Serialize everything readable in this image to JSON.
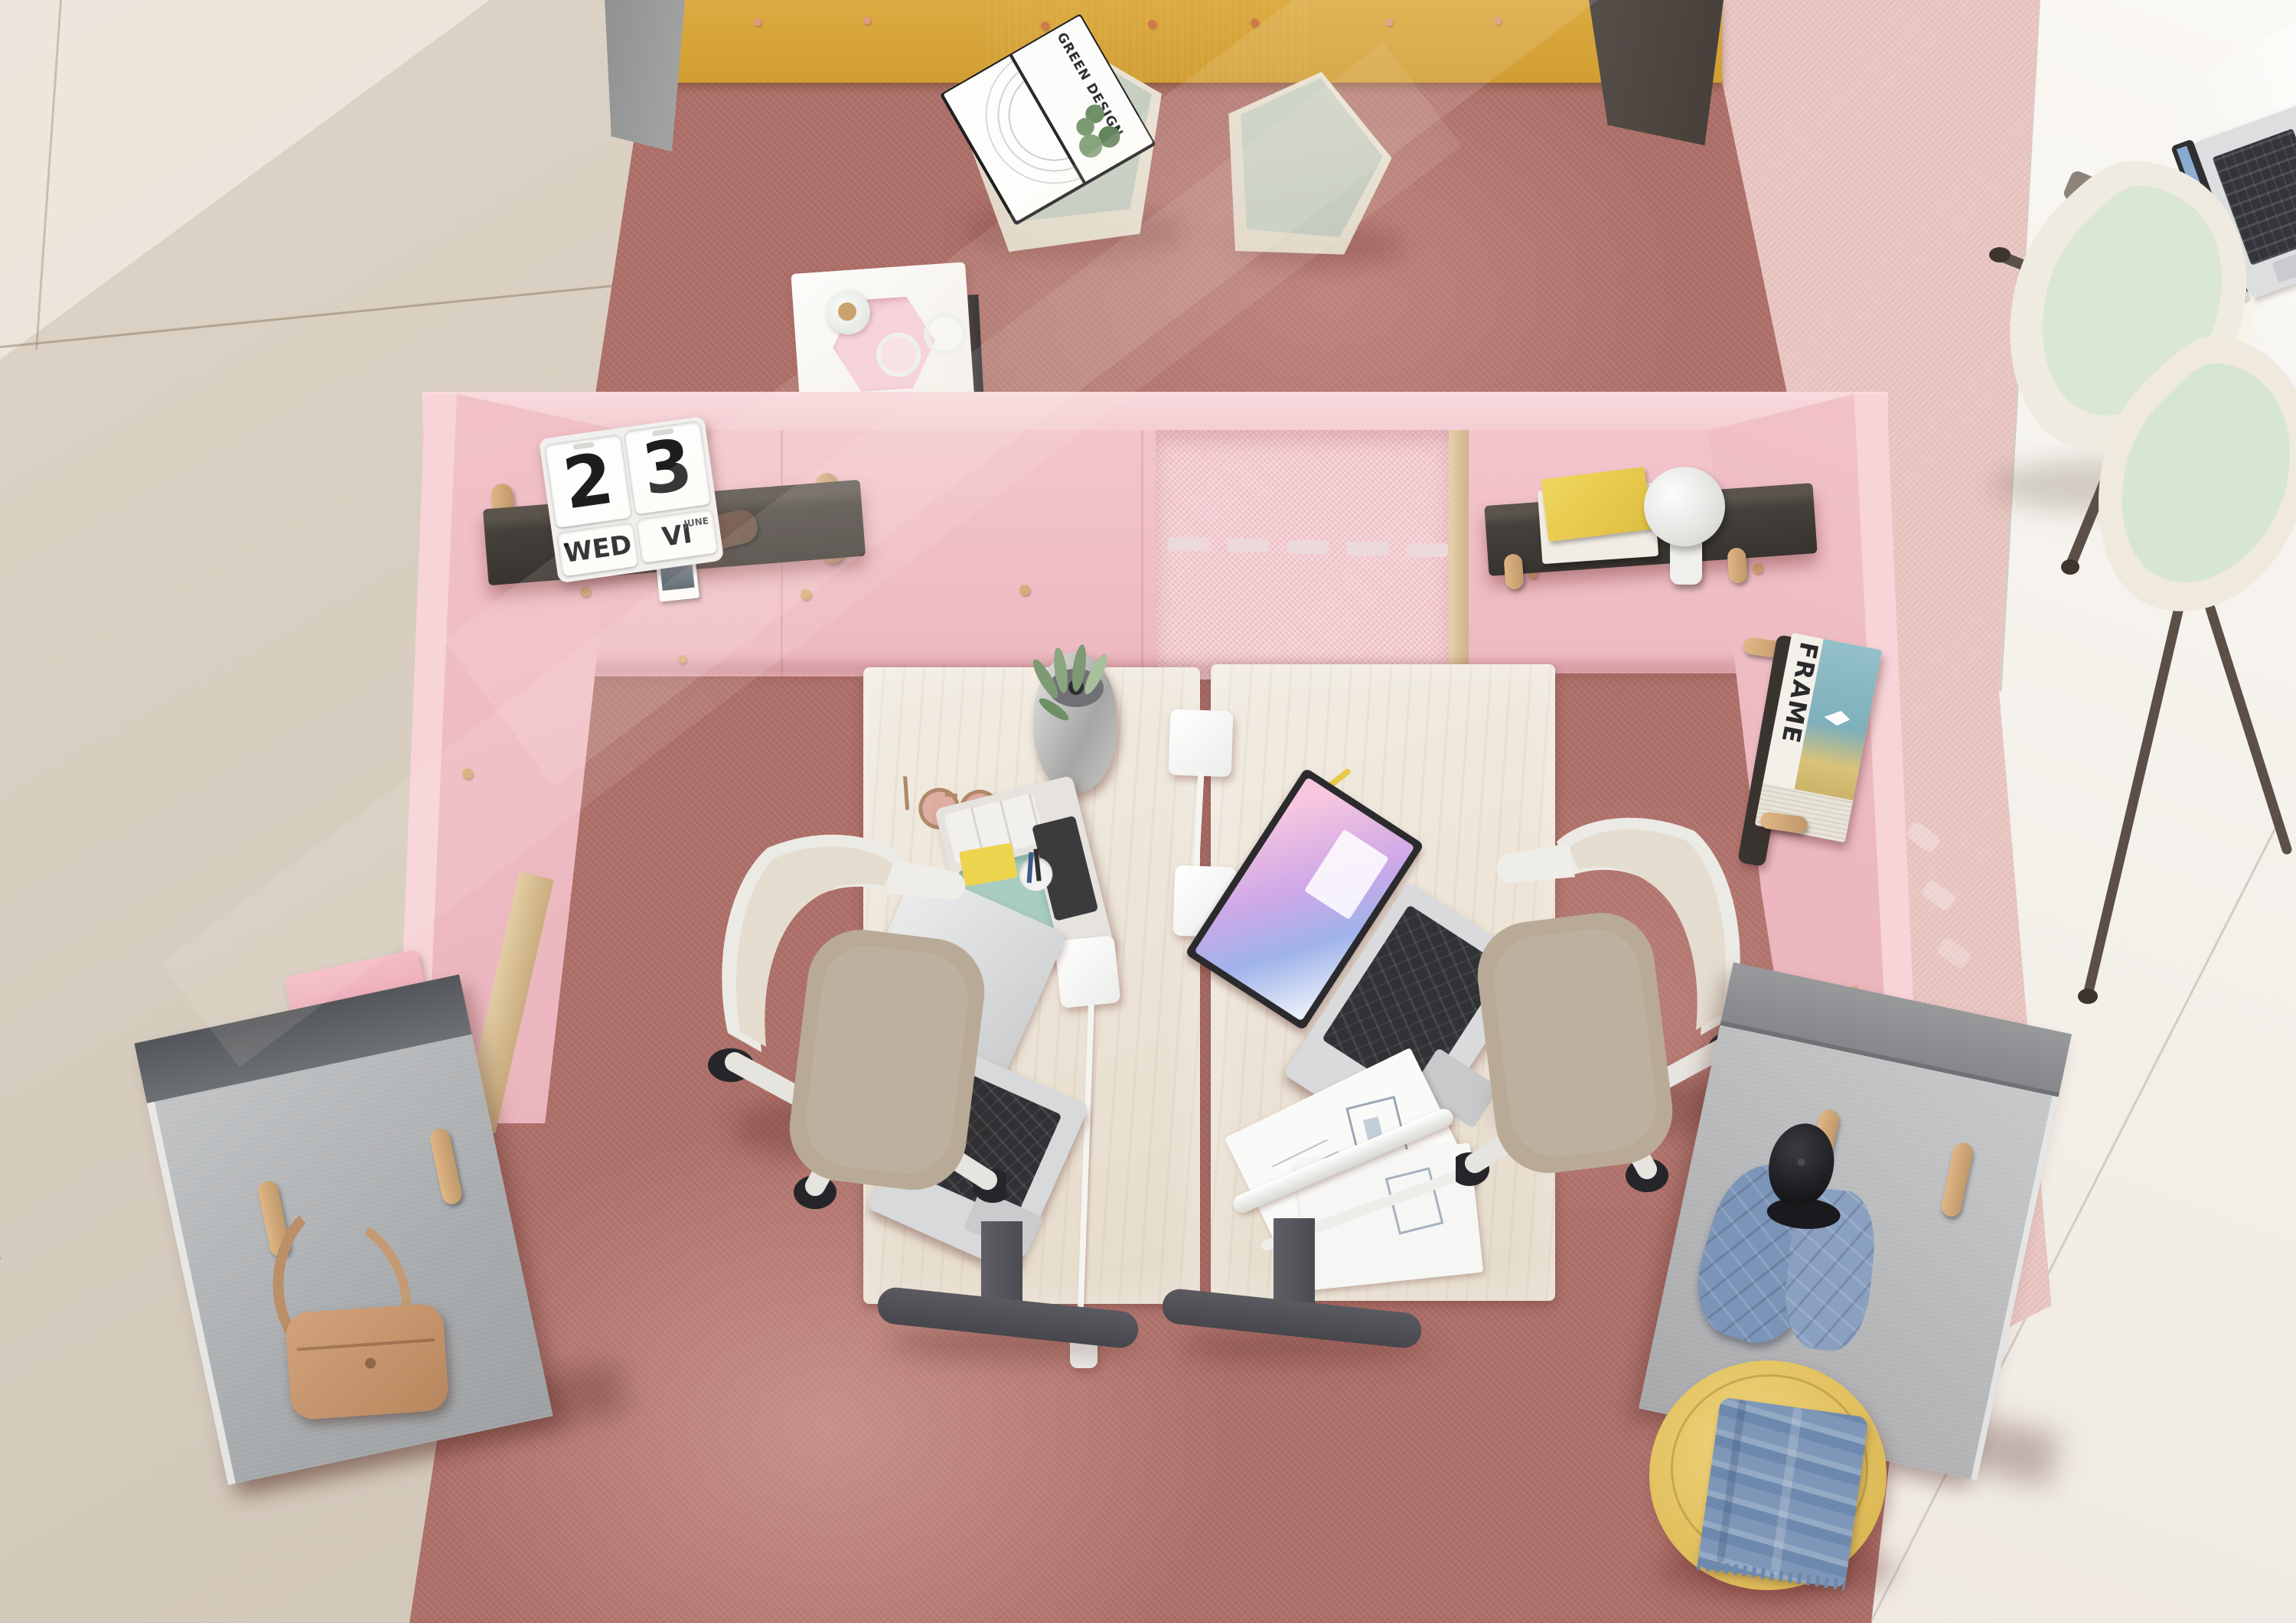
{
  "scene": {
    "description": "Bird's-eye view of a modern office pod: pink acoustic partition walls forming two workstations with light wood sit-stand desks, laptops, task chairs, rose-red carpet, gray coat panels, green poufs, a yellow pouf with a blue throw, and mint guest chairs on white tile at the right",
    "view": "top-down"
  },
  "calendar": {
    "digit_left": "2",
    "digit_right": "3",
    "day": "WED",
    "month_roman": "VI",
    "month": "JUNE"
  },
  "open_book": {
    "title_line1": "GREEN",
    "title_line2": "DESIGN"
  },
  "magazine": {
    "title": "FRAME"
  },
  "palette": {
    "carpet_main": "#ad6f68",
    "carpet_accent_pink": "#e9c6c2",
    "tile_beige": "#d8cec1",
    "floor_white": "#f7f4f0",
    "pod_wall_pink": "#f2c2c9",
    "pod_edge_pink": "#f6d4d8",
    "alcove_pink": "#f2cbd0",
    "storage_wall_yellow": "#d7a437",
    "storage_wall_dark": "#57504a",
    "coat_panel_gray": "#b0b2b4",
    "desk_wood": "#ece4d8",
    "desk_leg_gray": "#56565c",
    "pouf_green_top": "#c9d1c3",
    "pouf_side_cream": "#e8e1d3",
    "pouf_yellow": "#e2c160",
    "throw_blue": "#7e97b8",
    "chair_mint": "#d9e7d4",
    "shelf_dark": "#413c38",
    "peg_wood": "#d6ac79",
    "bag_tan": "#c89a76",
    "laptop_screen_gradient": [
      "#f6c6de",
      "#cfa8e8",
      "#9fb3ea"
    ]
  }
}
